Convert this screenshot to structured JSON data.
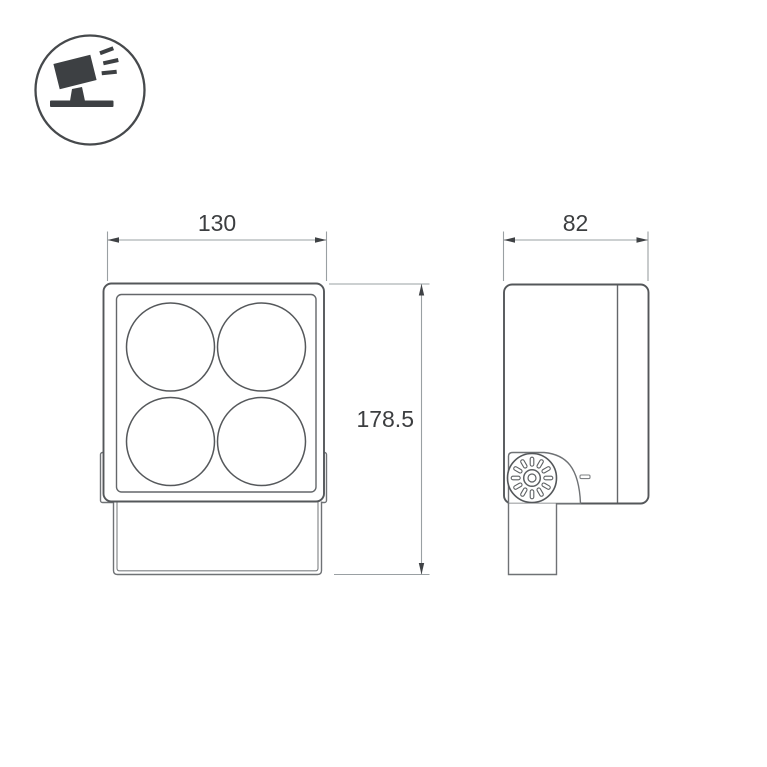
{
  "icon_badge": {
    "icon": "floodlight-tilt-icon"
  },
  "drawing": {
    "front_view": {
      "width_mm": "130",
      "height_mm": "178.5",
      "lens_count": 4
    },
    "side_view": {
      "depth_mm": "82"
    }
  },
  "colors": {
    "background": "#ffffff",
    "outline": "#54575a",
    "dimension_line": "#9aa0a3",
    "dimension_text": "#3c3e40",
    "icon_fill": "#3d4043"
  }
}
